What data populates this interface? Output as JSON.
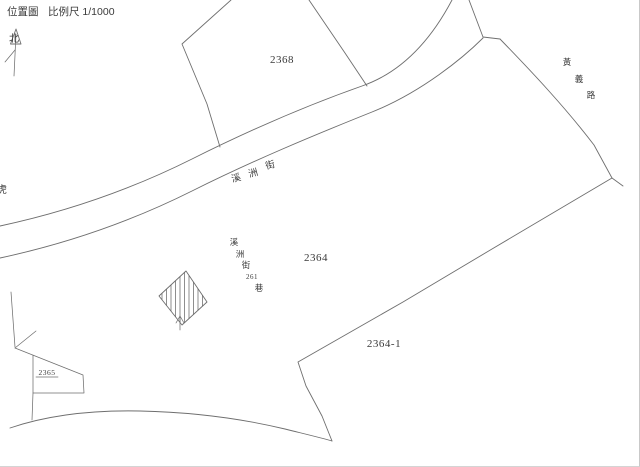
{
  "header": {
    "title": "位置圖",
    "scale_label": "比例尺 1/1000"
  },
  "compass": {
    "north_label": "北"
  },
  "parcels": {
    "p2368": {
      "label": "2368"
    },
    "p2364": {
      "label": "2364"
    },
    "p2364_1": {
      "label": "2364-1"
    },
    "p2365": {
      "label": "2365"
    }
  },
  "streets": {
    "xizhou": {
      "name": "溪洲街",
      "chars": [
        "溪",
        "洲",
        "街"
      ]
    },
    "huangyi": {
      "name": "黃義路",
      "chars": [
        "黃",
        "義",
        "路"
      ]
    },
    "lane261": {
      "name": "溪洲街261巷",
      "parts": [
        "溪",
        "洲",
        "街",
        "261",
        "巷"
      ]
    },
    "left_edge_partial_char": "虎"
  },
  "colors": {
    "line": "#6e6e6e",
    "text": "#3a3a3a",
    "background": "#ffffff"
  }
}
